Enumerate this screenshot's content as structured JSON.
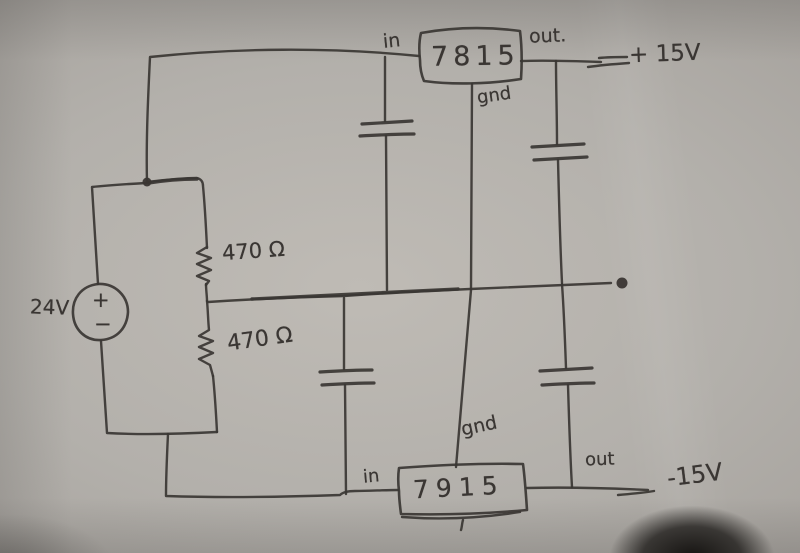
{
  "colors": {
    "paper": "#b3b0ab",
    "ink": "#3a3633"
  },
  "source": {
    "label": "24V",
    "plus": "+",
    "minus": "−"
  },
  "resistors": {
    "r1": "470 Ω",
    "r2": "470 Ω"
  },
  "regulators": {
    "top": {
      "part": "7815",
      "pin_in": "in",
      "pin_out": "out.",
      "pin_gnd": "gnd"
    },
    "bottom": {
      "part": "7915",
      "pin_in": "in",
      "pin_out": "out",
      "pin_gnd": "gnd"
    }
  },
  "rails": {
    "positive": "+ 15V",
    "negative": "-15V"
  }
}
